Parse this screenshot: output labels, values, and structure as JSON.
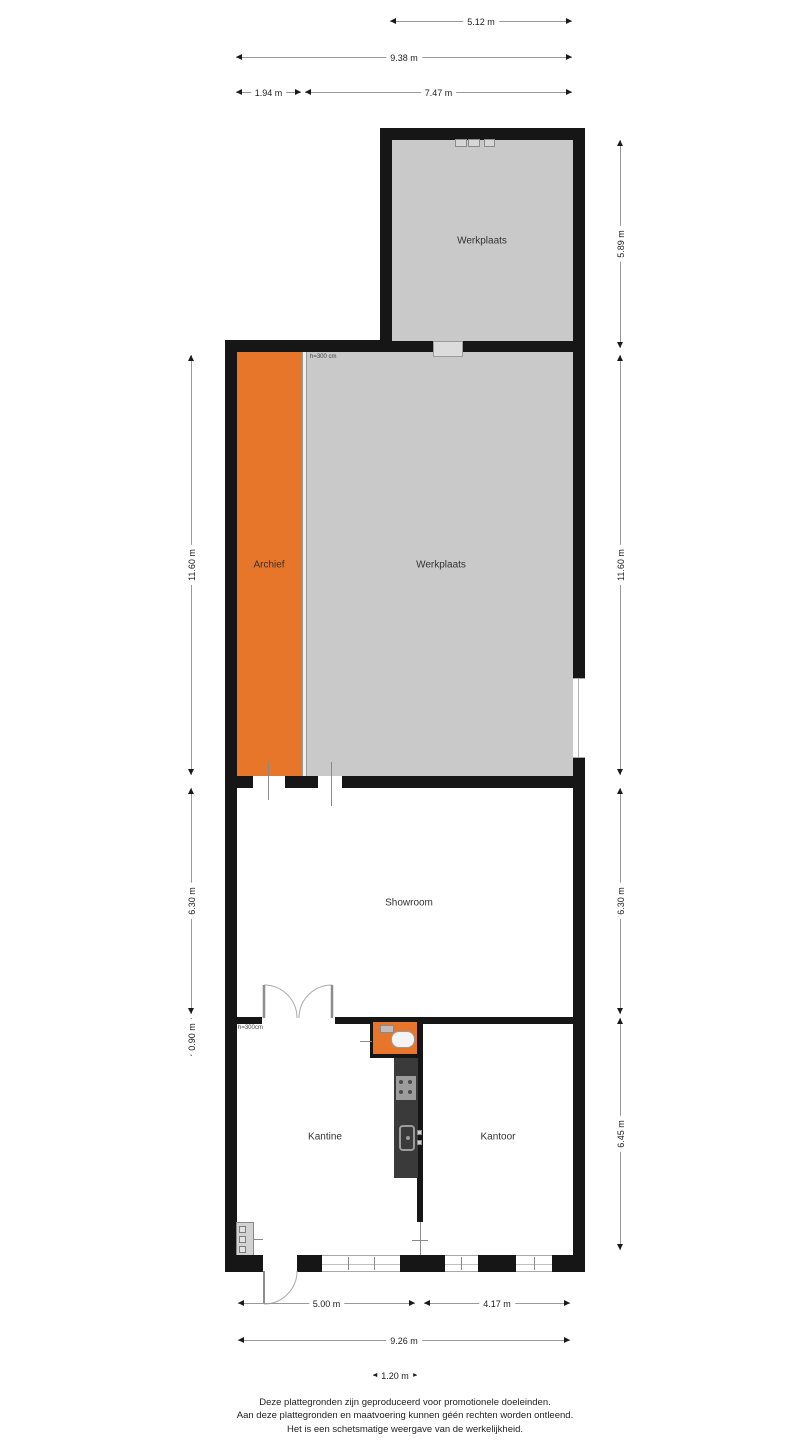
{
  "rooms": {
    "werkplaats_top": {
      "label": "Werkplaats"
    },
    "archief": {
      "label": "Archief"
    },
    "werkplaats_main": {
      "label": "Werkplaats",
      "height_note": "h=300 cm"
    },
    "showroom": {
      "label": "Showroom"
    },
    "kantine": {
      "label": "Kantine",
      "height_note": "h=300cm"
    },
    "kantoor": {
      "label": "Kantoor"
    }
  },
  "dimensions": {
    "top": [
      "5.12 m",
      "9.38 m",
      "1.94 m",
      "7.47 m"
    ],
    "left": [
      "11.60 m",
      "6.30 m",
      "0.90 m"
    ],
    "right": [
      "5.89 m",
      "11.60 m",
      "6.30 m",
      "6.45 m"
    ],
    "bottom": [
      "5.00 m",
      "4.17 m",
      "9.26 m",
      "1.20 m"
    ]
  },
  "colors": {
    "wall": "#161616",
    "room_gray": "#c9c9c9",
    "room_orange": "#e8762a",
    "dim_line": "#999999",
    "kitchen_dark": "#3a3a3a"
  },
  "footer": {
    "line1": "Deze plattegronden zijn geproduceerd voor promotionele doeleinden.",
    "line2": "Aan deze plattegronden en maatvoering kunnen géén rechten worden ontleend.",
    "line3": "Het is een schetsmatige weergave van de werkelijkheid."
  }
}
